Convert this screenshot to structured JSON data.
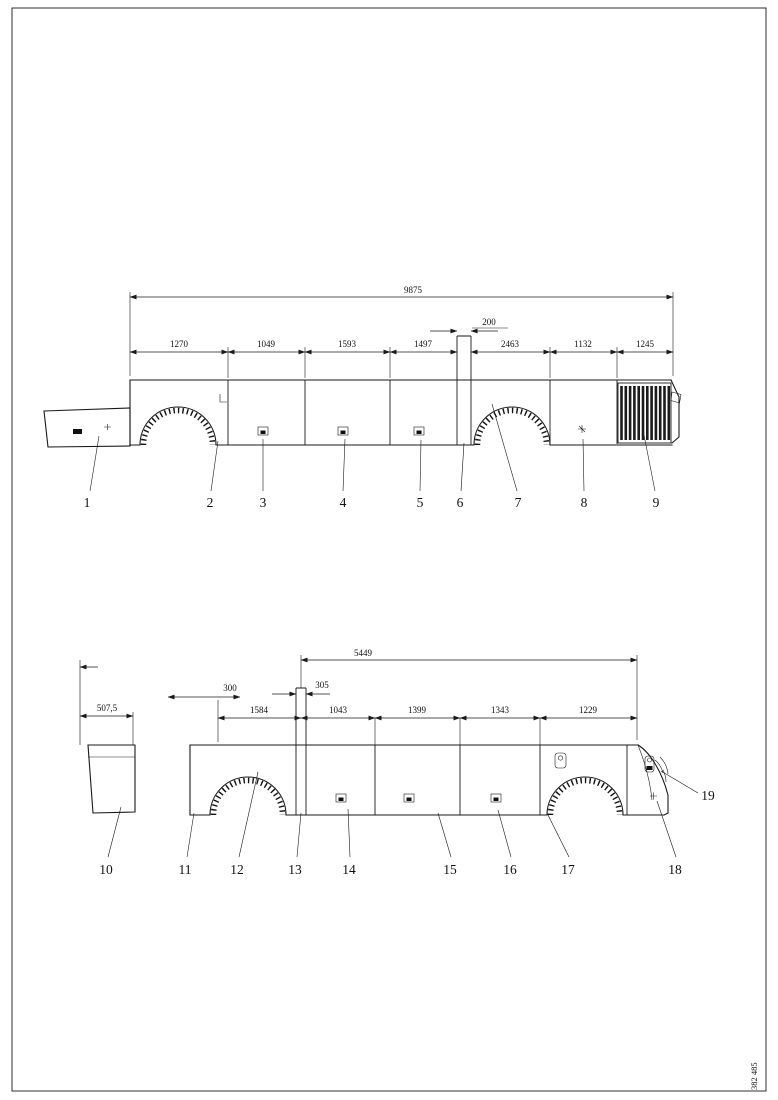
{
  "page": {
    "background": "#ffffff",
    "line_color": "#1a1a1a"
  },
  "footer": {
    "drawing_number": "382 485"
  },
  "top_view": {
    "dims": {
      "overall": "9875",
      "small": "200",
      "segments": [
        "1270",
        "1049",
        "1593",
        "1497",
        "2463",
        "1132",
        "1245"
      ]
    },
    "callouts": [
      "1",
      "2",
      "3",
      "4",
      "5",
      "6",
      "7",
      "8",
      "9"
    ]
  },
  "bottom_view": {
    "dims": {
      "overall": "5449",
      "left": "507,5",
      "small": [
        "300",
        "305"
      ],
      "segments": [
        "1584",
        "1043",
        "1399",
        "1343",
        "1229"
      ]
    },
    "callouts": [
      "10",
      "11",
      "12",
      "13",
      "14",
      "15",
      "16",
      "17",
      "18",
      "19"
    ]
  }
}
